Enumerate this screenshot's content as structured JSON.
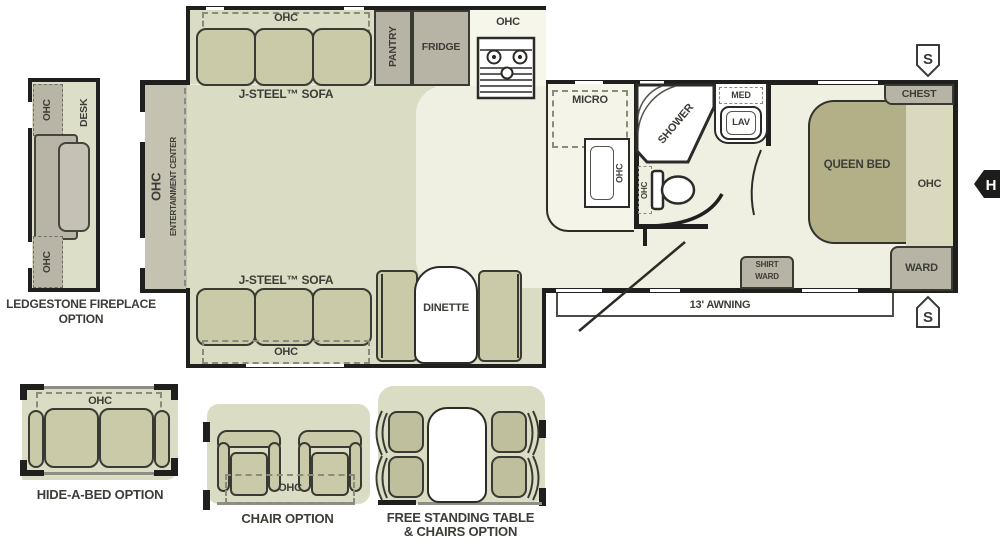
{
  "colors": {
    "wall": "#1f1f1e",
    "floor": "#eff0e1",
    "slide_floor": "#dadcc3",
    "cushion": "#cacaa9",
    "cabinet": "#b7b3a5",
    "bed": "#b3b087",
    "text": "#3d3d38"
  },
  "main": {
    "sofa_top": {
      "ohc": "OHC",
      "label": "J-STEEL™ SOFA"
    },
    "sofa_bottom": {
      "ohc": "OHC",
      "label": "J-STEEL™ SOFA"
    },
    "entertainment": {
      "ohc": "OHC",
      "label": "ENTERTAINMENT CENTER"
    },
    "kitchen": {
      "pantry": "PANTRY",
      "fridge": "FRIDGE",
      "range_ohc": "OHC",
      "micro": "MICRO",
      "sink_ohc": "OHC"
    },
    "bath": {
      "shower": "SHOWER",
      "med": "MED",
      "lav": "LAV",
      "toilet_ohc": "OHC"
    },
    "bedroom": {
      "chest": "CHEST",
      "bed": "QUEEN BED",
      "ohc": "OHC",
      "ward": "WARD",
      "shirt_ward_1": "SHIRT",
      "shirt_ward_2": "WARD"
    },
    "dinette": "DINETTE",
    "awning": "13' AWNING",
    "speaker": "S",
    "hitch": "H"
  },
  "options": {
    "fireplace": {
      "ohc_top": "OHC",
      "desk": "DESK",
      "ohc_bottom": "OHC",
      "caption_1": "LEDGESTONE FIREPLACE",
      "caption_2": "OPTION"
    },
    "hide_a_bed": {
      "ohc": "OHC",
      "caption": "HIDE-A-BED OPTION"
    },
    "chair": {
      "ohc": "OHC",
      "caption": "CHAIR OPTION"
    },
    "free_table": {
      "caption_1": "FREE STANDING TABLE",
      "caption_2": "& CHAIRS OPTION"
    }
  }
}
